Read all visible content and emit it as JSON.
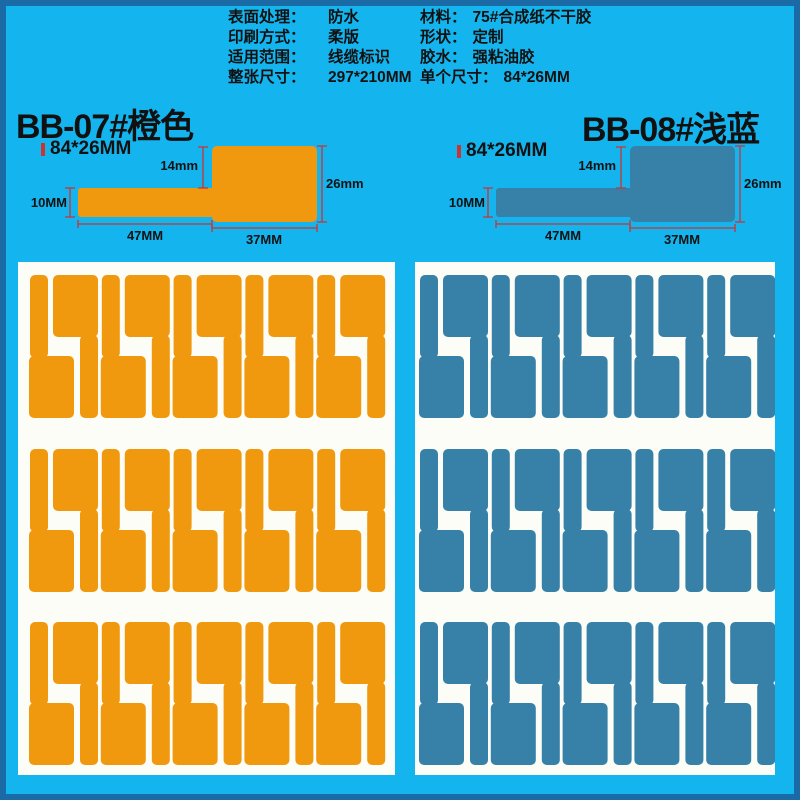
{
  "colors": {
    "background": "#14b5ee",
    "frame": "#1a6aa6",
    "orange": "#f0990f",
    "light_blue": "#3781a8",
    "sheet_white": "#fbfdf6",
    "dimension_red": "#cc3333",
    "text": "#111111"
  },
  "specs": {
    "left": [
      {
        "label": "表面处理：",
        "value": "防水"
      },
      {
        "label": "印刷方式：",
        "value": "柔版"
      },
      {
        "label": "适用范围：",
        "value": "线缆标识"
      },
      {
        "label": "整张尺寸：",
        "value": "297*210MM"
      }
    ],
    "right": [
      {
        "label": "材料：",
        "value": "75#合成纸不干胶"
      },
      {
        "label": "形状：",
        "value": "定制"
      },
      {
        "label": "胶水：",
        "value": "强粘油胶"
      },
      {
        "label": "单个尺寸：",
        "value": "84*26MM"
      }
    ]
  },
  "products": [
    {
      "id": "BB-07",
      "title": "BB-07#橙色",
      "size": "84*26MM",
      "color_hex": "#f0990f"
    },
    {
      "id": "BB-08",
      "title": "BB-08#浅蓝",
      "size": "84*26MM",
      "color_hex": "#3781a8"
    }
  ],
  "diagram": {
    "dims": {
      "head_top_offset": "14mm",
      "head_height": "26mm",
      "tail_height": "10MM",
      "tail_length": "47MM",
      "head_length": "37MM"
    }
  },
  "sheets": {
    "rows": 3,
    "labels_per_row": 10,
    "labels_per_sheet": 30
  }
}
